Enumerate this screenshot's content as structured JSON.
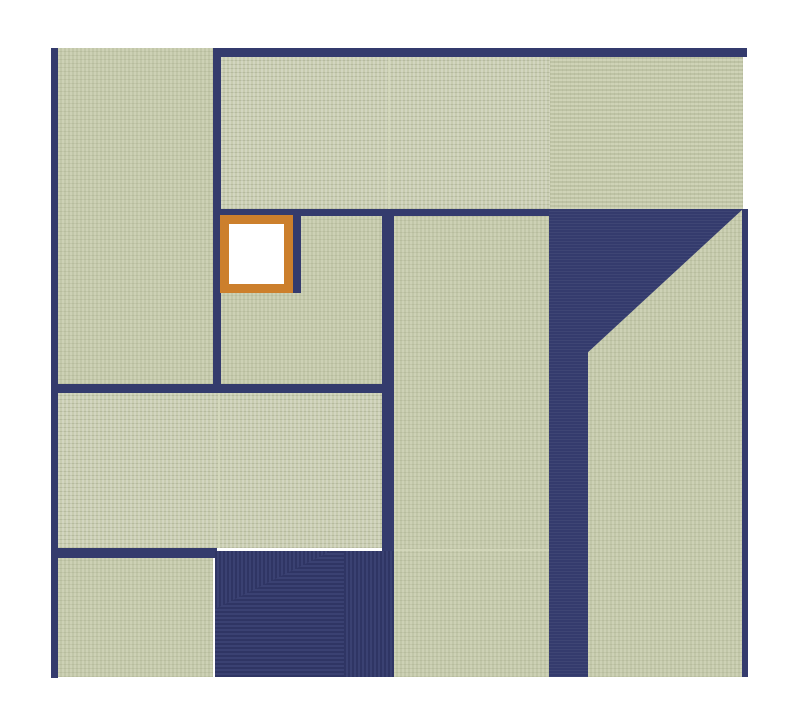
{
  "canvas": {
    "width": 800,
    "height": 720,
    "background": "#ffffff"
  },
  "palette": {
    "mat": "#c8ccb0",
    "mat_stripe_light": "#cdd1b5",
    "mat_stripe_dark": "#c2c7a9",
    "gap": "#343b6d",
    "gap_stripe_dark": "#2f3564",
    "gap_stripe_light": "#3a4172",
    "seam": "#d6dabd",
    "highlight_border": "#cc7f2c",
    "highlight_fill": "#ffffff"
  },
  "board": {
    "mats": [
      {
        "id": "mat-left-upper",
        "x": 58,
        "y": 48,
        "w": 155,
        "h": 336,
        "weave": "v"
      },
      {
        "id": "mat-top-center",
        "x": 221,
        "y": 57,
        "w": 329,
        "h": 152,
        "weave": "hd"
      },
      {
        "id": "mat-top-right",
        "x": 550,
        "y": 57,
        "w": 193,
        "h": 152,
        "weave": "h"
      },
      {
        "id": "mat-center-left",
        "x": 221,
        "y": 216,
        "w": 161,
        "h": 168,
        "weave": "v"
      },
      {
        "id": "mat-center",
        "x": 394,
        "y": 216,
        "w": 155,
        "h": 461,
        "weave": "v"
      },
      {
        "id": "mat-right",
        "x": 588,
        "y": 209,
        "w": 154,
        "h": 468,
        "weave": "v",
        "clip": "polygon(100% 0, 0 30.6%, 0 100%, 100% 100%)"
      },
      {
        "id": "mat-middle-left",
        "x": 58,
        "y": 393,
        "w": 324,
        "h": 155,
        "weave": "hd"
      },
      {
        "id": "mat-bottom-left",
        "x": 58,
        "y": 558,
        "w": 155,
        "h": 119,
        "weave": "v"
      }
    ],
    "gaps": [
      {
        "id": "wall-left",
        "x": 51,
        "y": 48,
        "w": 7,
        "h": 630,
        "texture": "plain"
      },
      {
        "id": "wall-top",
        "x": 213,
        "y": 48,
        "w": 534,
        "h": 9,
        "texture": "plain"
      },
      {
        "id": "wall-upper-left-vertical",
        "x": 213,
        "y": 57,
        "w": 8,
        "h": 336,
        "texture": "plain"
      },
      {
        "id": "wall-under-top-mats",
        "x": 213,
        "y": 209,
        "w": 337,
        "h": 7,
        "texture": "plain"
      },
      {
        "id": "wall-right-of-highlight",
        "x": 293,
        "y": 209,
        "w": 8,
        "h": 84,
        "texture": "plain"
      },
      {
        "id": "wall-center-vertical",
        "x": 382,
        "y": 209,
        "w": 12,
        "h": 468,
        "texture": "plain"
      },
      {
        "id": "wall-middle-horizontal",
        "x": 51,
        "y": 384,
        "w": 343,
        "h": 9,
        "texture": "plain"
      },
      {
        "id": "wall-lower-horizontal",
        "x": 51,
        "y": 548,
        "w": 166,
        "h": 10,
        "texture": "plain"
      },
      {
        "id": "gap-right-large",
        "x": 549,
        "y": 209,
        "w": 194,
        "h": 468,
        "texture": "ribs",
        "clip": "polygon(0 0, 100% 0, 20.1% 30.6%, 20.1% 100%, 0 100%)"
      },
      {
        "id": "wall-right",
        "x": 742,
        "y": 209,
        "w": 6,
        "h": 468,
        "texture": "plain"
      },
      {
        "id": "court-dark",
        "x": 215,
        "y": 551,
        "w": 179,
        "h": 126,
        "texture": "miter"
      }
    ],
    "seams": [
      {
        "id": "seam-top-center",
        "x": 388,
        "y": 57,
        "w": 2,
        "h": 152
      },
      {
        "id": "seam-middle-left",
        "x": 218,
        "y": 393,
        "w": 2,
        "h": 155
      },
      {
        "id": "seam-center",
        "x": 394,
        "y": 549,
        "w": 155,
        "h": 2
      }
    ],
    "highlight": {
      "id": "highlight-square",
      "x": 220,
      "y": 215,
      "w": 73,
      "h": 78,
      "border_width": 9
    }
  }
}
